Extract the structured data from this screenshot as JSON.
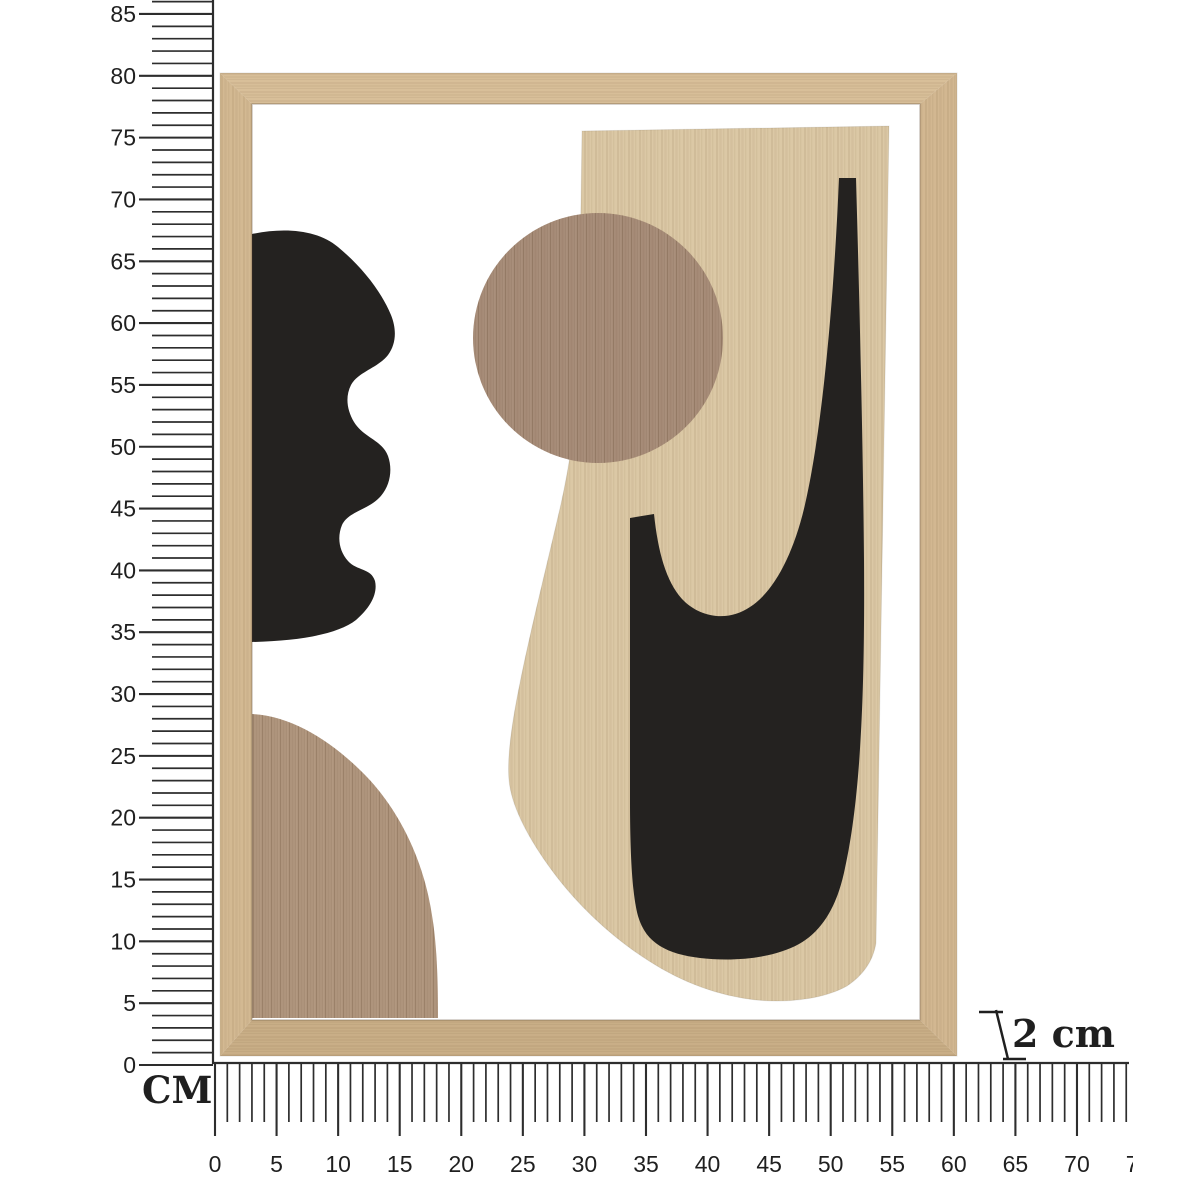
{
  "rulers": {
    "unit_label": "CM",
    "vertical": {
      "labels": [
        "85",
        "80",
        "75",
        "70",
        "65",
        "60",
        "55",
        "50",
        "45",
        "40",
        "35",
        "30",
        "25",
        "20",
        "15",
        "10",
        "5",
        "0"
      ],
      "tick_count": 87,
      "label_step": 5
    },
    "horizontal": {
      "labels": [
        "0",
        "5",
        "10",
        "15",
        "20",
        "25",
        "30",
        "35",
        "40",
        "45",
        "50",
        "55",
        "60",
        "65",
        "70",
        "75"
      ],
      "tick_count": 75,
      "label_step": 5
    }
  },
  "depth_annotation": {
    "label": "2 cm"
  },
  "colors": {
    "frame_top": "#d8bf99",
    "frame_right": "#d2b791",
    "frame_bottom": "#c9ae87",
    "frame_left": "#d3b992",
    "panel_wood": "#dbc8a5",
    "circle_wood": "#a98f7b",
    "arch_wood": "#b29880",
    "shape_black": "#242220",
    "ruler": "#2d2d2d",
    "label_text": "#1f1f1f"
  }
}
